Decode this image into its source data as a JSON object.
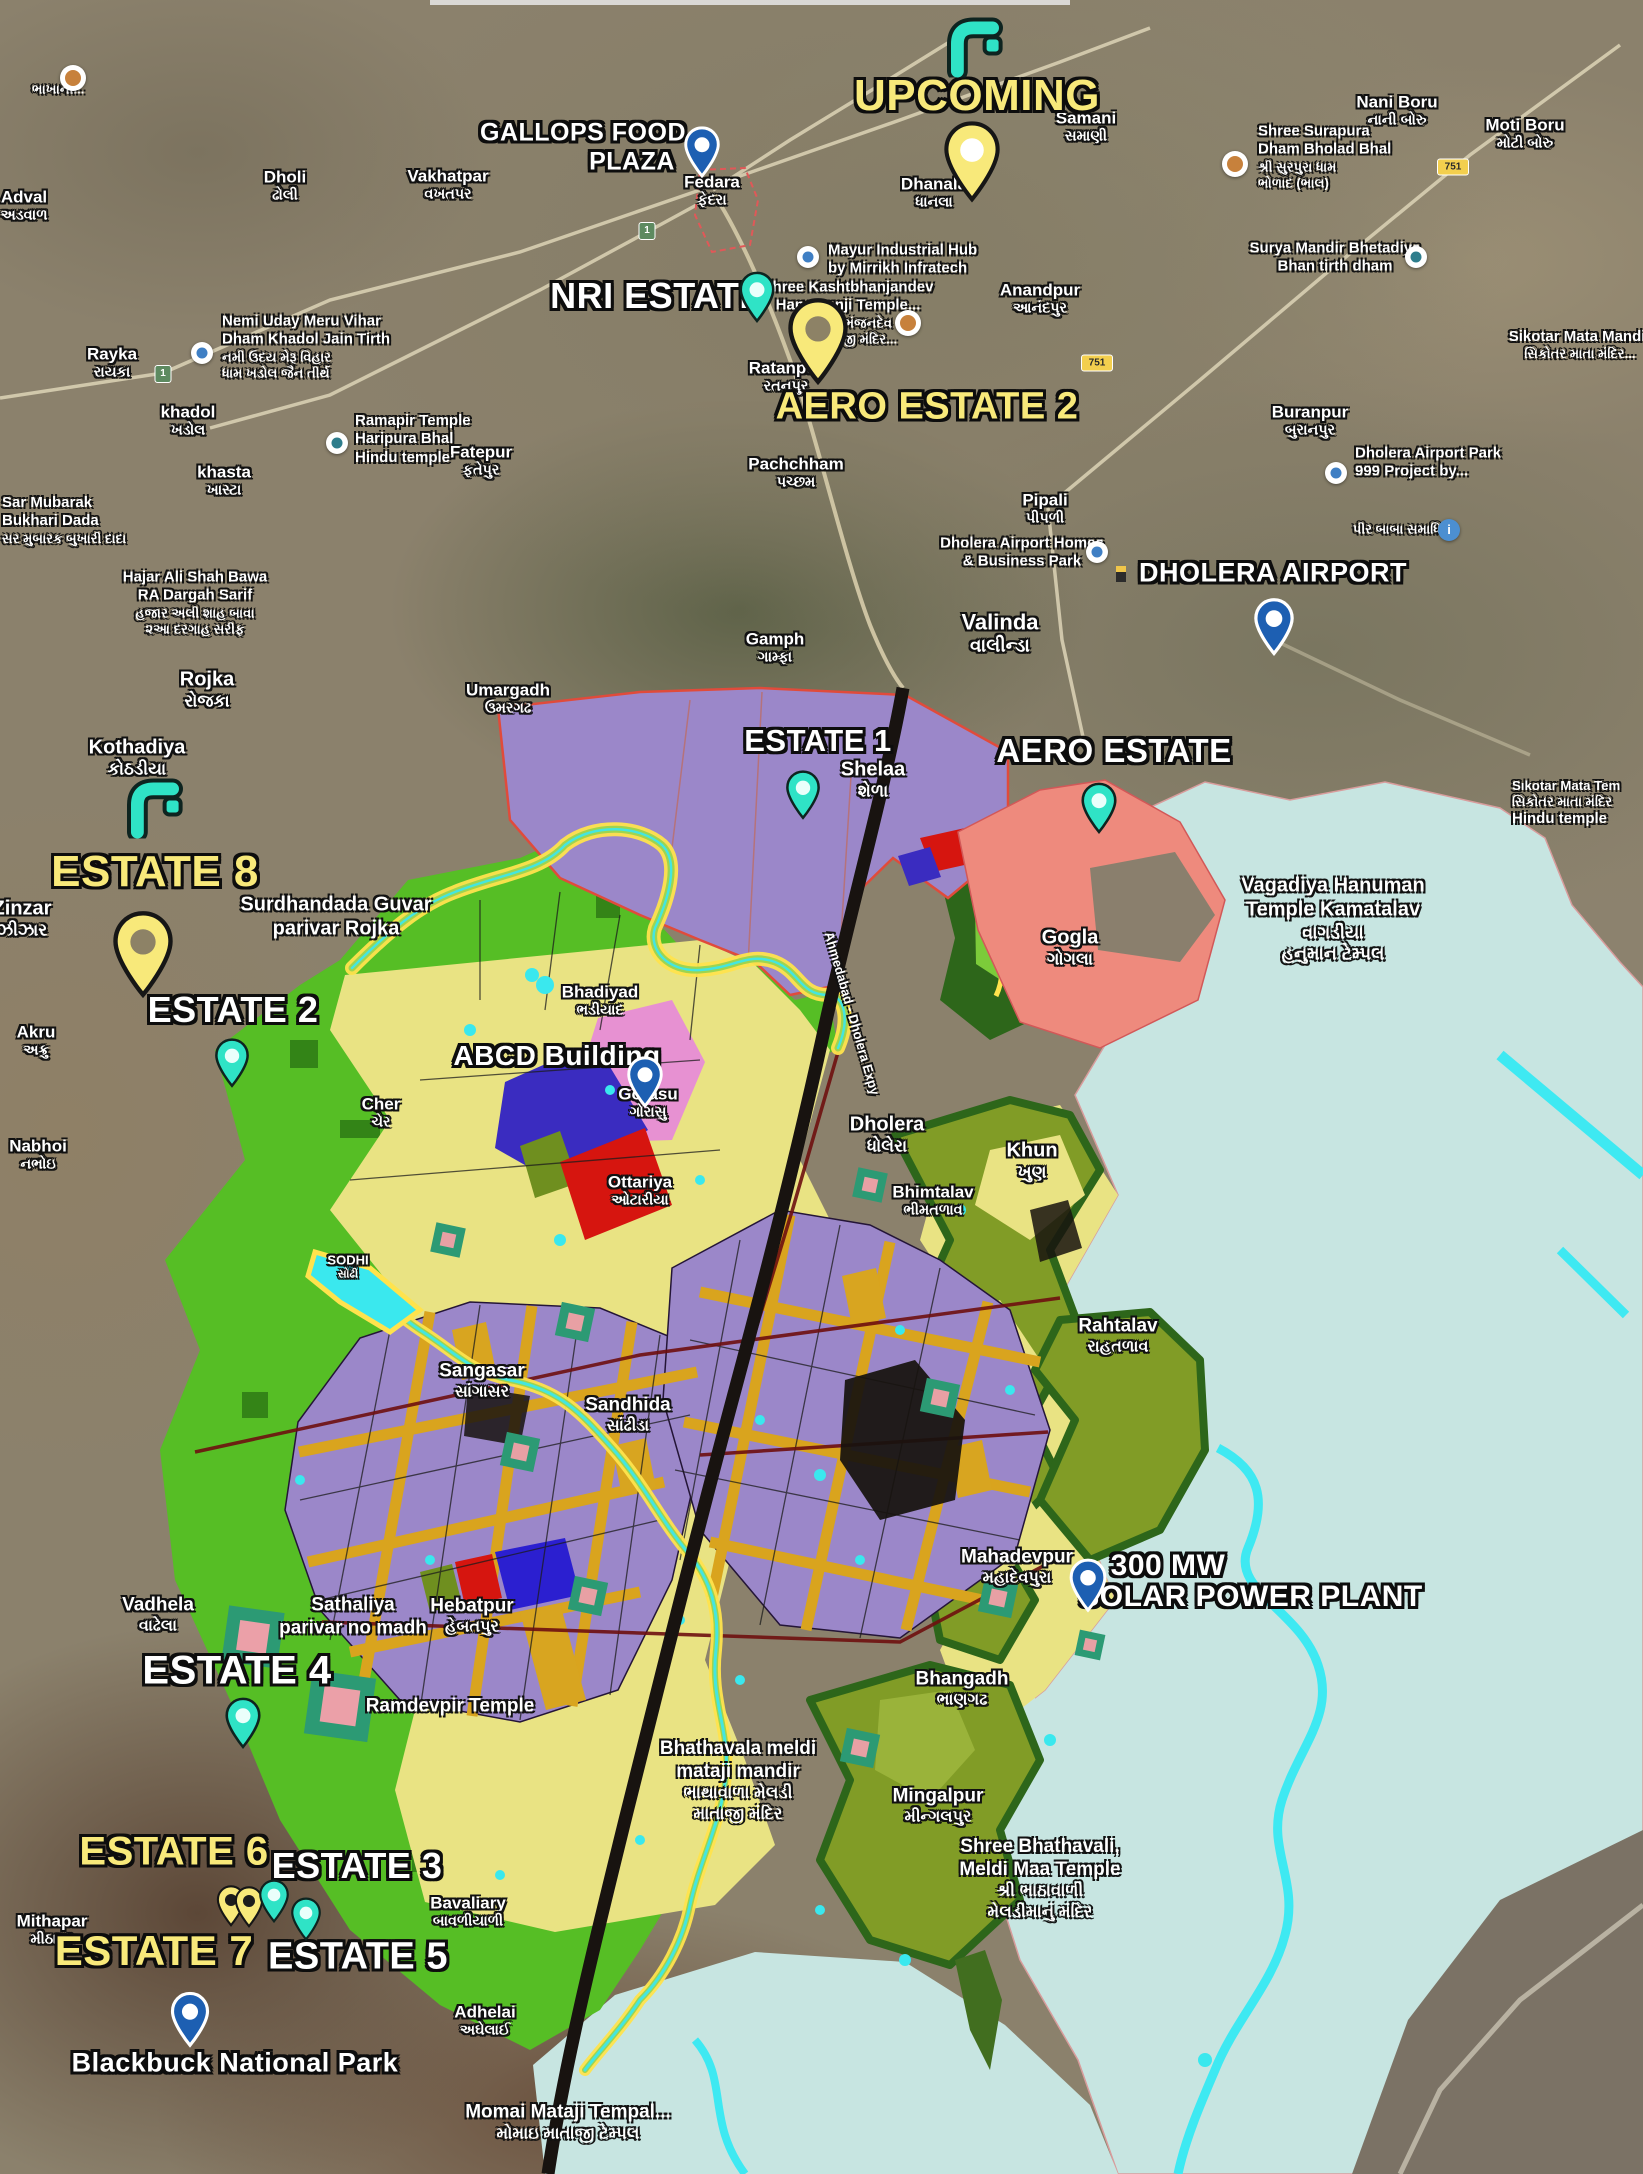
{
  "colors": {
    "teal_pin": "#2fe3c6",
    "yellow_pin": "#f8e97a",
    "blue_pin": "#1d5fb2",
    "yellow_label": "#f8e97a",
    "white_label": "#ffffff",
    "zone_green": "#56be25",
    "zone_khaki": "#e9e383",
    "zone_purple": "#9b87c9",
    "zone_olive": "#819c26",
    "zone_water": "#c7e5e1",
    "zone_salmon": "#ee8a7d",
    "stream_cyan": "#3ee9f2"
  },
  "map": {
    "expressway_label": "Ahmedabad - Dholera Expy",
    "estate_labels": [
      {
        "text": "UPCOMING",
        "color": "yellow",
        "x": 977,
        "y": 96,
        "size": 44
      },
      {
        "text": "GALLOPS FOOD",
        "color": "white",
        "x": 583,
        "y": 133,
        "size": 25
      },
      {
        "text": "PLAZA",
        "color": "white",
        "x": 632,
        "y": 162,
        "size": 25
      },
      {
        "text": "NRI ESTATE",
        "color": "white",
        "x": 657,
        "y": 296,
        "size": 36
      },
      {
        "text": "AERO ESTATE 2",
        "color": "yellow",
        "x": 927,
        "y": 407,
        "size": 38
      },
      {
        "text": "DHOLERA AIRPORT",
        "color": "white",
        "x": 1273,
        "y": 573,
        "size": 27
      },
      {
        "text": "ESTATE 1",
        "color": "white",
        "x": 818,
        "y": 741,
        "size": 31
      },
      {
        "text": "AERO ESTATE",
        "color": "white",
        "x": 1114,
        "y": 751,
        "size": 33
      },
      {
        "text": "ESTATE 8",
        "color": "yellow",
        "x": 155,
        "y": 872,
        "size": 44
      },
      {
        "text": "ESTATE 2",
        "color": "white",
        "x": 233,
        "y": 1010,
        "size": 36
      },
      {
        "text": "ABCD Building",
        "color": "white",
        "x": 557,
        "y": 1056,
        "size": 28
      },
      {
        "text": "300 MW",
        "color": "white",
        "x": 1168,
        "y": 1566,
        "size": 30
      },
      {
        "text": "SOLAR POWER PLANT",
        "color": "white",
        "x": 1251,
        "y": 1597,
        "size": 30
      },
      {
        "text": "ESTATE 4",
        "color": "white",
        "x": 237,
        "y": 1671,
        "size": 40
      },
      {
        "text": "ESTATE 6",
        "color": "yellow",
        "x": 174,
        "y": 1852,
        "size": 40
      },
      {
        "text": "ESTATE 3",
        "color": "white",
        "x": 357,
        "y": 1866,
        "size": 36
      },
      {
        "text": "ESTATE 7",
        "color": "yellow",
        "x": 154,
        "y": 1951,
        "size": 42
      },
      {
        "text": "ESTATE 5",
        "color": "white",
        "x": 358,
        "y": 1957,
        "size": 38
      },
      {
        "text": "Blackbuck National Park",
        "color": "white",
        "x": 235,
        "y": 2063,
        "size": 27
      }
    ],
    "place_labels": [
      {
        "en": "Dholi",
        "gu": "ઢોલી",
        "x": 285,
        "y": 185
      },
      {
        "en": "Vakhatpar",
        "gu": "વખતપર",
        "x": 448,
        "y": 184
      },
      {
        "en": "Adval",
        "gu": "અડવાળ",
        "x": 24,
        "y": 205
      },
      {
        "en": "Dhanala",
        "gu": "ધાનલા",
        "x": 934,
        "y": 192
      },
      {
        "en": "Samani",
        "gu": "સમાણી",
        "x": 1086,
        "y": 126
      },
      {
        "en": "Nani Boru",
        "gu": "નાની બોરુ",
        "x": 1397,
        "y": 110
      },
      {
        "en": "Moti Boru",
        "gu": "મોટી બોરુ",
        "x": 1525,
        "y": 133
      },
      {
        "en": "Fedara",
        "gu": "ફેદરા",
        "x": 712,
        "y": 190
      },
      {
        "en": "Rayka",
        "gu": "રાયકા",
        "x": 112,
        "y": 362
      },
      {
        "en": "khadol",
        "gu": "ખડોલ",
        "x": 188,
        "y": 420
      },
      {
        "en": "khasta",
        "gu": "ખાસ્ટા",
        "x": 224,
        "y": 480
      },
      {
        "en": "Fatepur",
        "gu": "ફતેપુર",
        "x": 481,
        "y": 460
      },
      {
        "en": "Pachchham",
        "gu": "પચ્છમ",
        "x": 796,
        "y": 472
      },
      {
        "en": "Ratanpur",
        "gu": "રતનપુર",
        "x": 786,
        "y": 376
      },
      {
        "en": "Anandpur",
        "gu": "આનંદપુર",
        "x": 1040,
        "y": 298
      },
      {
        "en": "Buranpur",
        "gu": "બુરાનપુર",
        "x": 1310,
        "y": 420
      },
      {
        "en": "Pipali",
        "gu": "પીપળી",
        "x": 1045,
        "y": 508
      },
      {
        "en": "Valinda",
        "gu": "વાલીન્ડા",
        "x": 1000,
        "y": 632,
        "size": 22
      },
      {
        "en": "Gamph",
        "gu": "ગામ્ફા",
        "x": 775,
        "y": 647
      },
      {
        "en": "Umargadh",
        "gu": "ઉમરગઢ",
        "x": 508,
        "y": 698
      },
      {
        "en": "Rojka",
        "gu": "રોજકા",
        "x": 207,
        "y": 689,
        "size": 20
      },
      {
        "en": "Kothadiya",
        "gu": "કોઠડીયા",
        "x": 137,
        "y": 757,
        "size": 20
      },
      {
        "en": "Zinzar",
        "gu": "ઝીઝાર",
        "x": 22,
        "y": 918,
        "size": 20
      },
      {
        "en": "Akru",
        "gu": "અક્રુ",
        "x": 36,
        "y": 1040
      },
      {
        "en": "Nabhoi",
        "gu": "નભોઇ",
        "x": 38,
        "y": 1154
      },
      {
        "en": "Shelaa",
        "gu": "શેળા",
        "x": 873,
        "y": 779,
        "size": 20
      },
      {
        "en": "Gogla",
        "gu": "ગોગલા",
        "x": 1070,
        "y": 947,
        "size": 20
      },
      {
        "en": "Bhadiyad",
        "gu": "ભડીયાદ",
        "x": 600,
        "y": 1000
      },
      {
        "en": "Cher",
        "gu": "ચેર",
        "x": 381,
        "y": 1112
      },
      {
        "en": "Gorasu",
        "gu": "ગોરાસુ",
        "x": 648,
        "y": 1102
      },
      {
        "en": "Ottariya",
        "gu": "ઓટારીયા",
        "x": 640,
        "y": 1190
      },
      {
        "en": "Dholera",
        "gu": "ધોલેરા",
        "x": 887,
        "y": 1134,
        "size": 20
      },
      {
        "en": "Khun",
        "gu": "ખુણ",
        "x": 1032,
        "y": 1160,
        "size": 20
      },
      {
        "en": "Bhimtalav",
        "gu": "ભીમતળાવ",
        "x": 933,
        "y": 1200
      },
      {
        "en": "SODHI",
        "gu": "સોઢી",
        "x": 348,
        "y": 1267,
        "size": 13
      },
      {
        "en": "Sangasar",
        "gu": "સાંગાસર",
        "x": 482,
        "y": 1380,
        "size": 19
      },
      {
        "en": "Sandhida",
        "gu": "સાંઢીડા",
        "x": 628,
        "y": 1414,
        "size": 19
      },
      {
        "en": "Rahtalav",
        "gu": "રાહતળાવ",
        "x": 1118,
        "y": 1335,
        "size": 19
      },
      {
        "en": "Mahadevpur",
        "gu": "મહાદેવપુરા",
        "x": 1017,
        "y": 1566,
        "size": 19
      },
      {
        "en": "Vadhela",
        "gu": "વાઢેલા",
        "x": 158,
        "y": 1614,
        "size": 19
      },
      {
        "en": "Hebatpur",
        "gu": "હેબતપુર",
        "x": 472,
        "y": 1615,
        "size": 19
      },
      {
        "en": "Bhangadh",
        "gu": "ભાણગઢ",
        "x": 962,
        "y": 1688,
        "size": 19
      },
      {
        "en": "Mingalpur",
        "gu": "મીન્ગલપુર",
        "x": 938,
        "y": 1805,
        "size": 19
      },
      {
        "en": "Mithapar",
        "gu": "મીઠાપર",
        "x": 52,
        "y": 1929
      },
      {
        "en": "Bavaliary",
        "gu": "બાવળીયાળી",
        "x": 468,
        "y": 1911
      },
      {
        "en": "Adhelai",
        "gu": "અઘેલાઈ",
        "x": 485,
        "y": 2020
      }
    ],
    "poi_labels": [
      {
        "lines": [
          "ભાખાની..."
        ],
        "x": 32,
        "y": 88,
        "align": "left"
      },
      {
        "lines": [
          "Shree Surapura",
          "Dham Bholad Bhal",
          "શ્રી સુરપુરા ધામ",
          "ભોળાદ (ભાલ)"
        ],
        "x": 1258,
        "y": 150,
        "align": "left"
      },
      {
        "lines": [
          "Surya Mandir Bhetadiya",
          "Bhan tirth dham"
        ],
        "x": 1335,
        "y": 254
      },
      {
        "lines": [
          "Sikotar Mata Mandir",
          "સિકોતર માતા મંદિર..."
        ],
        "x": 1580,
        "y": 342
      },
      {
        "lines": [
          "Nemi Uday Meru Vihar",
          "Dham Khadol Jain Tirth",
          "નમી ઉદય મેરૂ વિહાર",
          "ધામ ખડોલ જૈન તીર્થ"
        ],
        "x": 222,
        "y": 340,
        "align": "left"
      },
      {
        "lines": [
          "Ramapir Temple",
          "Haripura Bhal",
          "Hindu temple"
        ],
        "x": 355,
        "y": 434,
        "align": "left"
      },
      {
        "lines": [
          "Sar Mubarak",
          "Bukhari Dada",
          "સર મુબારક બુખારી દાદા"
        ],
        "x": 2,
        "y": 515,
        "align": "left"
      },
      {
        "lines": [
          "Hajar Ali Shah Bawa",
          "RA Dargah Sarif",
          "હજાર અલી શાહ બાવા",
          "૨આ દરગાહ સરીફ"
        ],
        "x": 195,
        "y": 596
      },
      {
        "lines": [
          "Mayur Industrial Hub",
          "by Mirrikh Infratech"
        ],
        "x": 828,
        "y": 256,
        "align": "left"
      },
      {
        "lines": [
          "Shree Kashtbhanjandev",
          "Hanumanji Temple...",
          "શ્રી કષ્ટભંજનદેવ",
          "હનુમાનજી મંદિર..."
        ],
        "x": 848,
        "y": 306
      },
      {
        "lines": [
          "Dholera Airport Park",
          "999 Project by..."
        ],
        "x": 1355,
        "y": 459,
        "align": "left"
      },
      {
        "lines": [
          "પીર બાબા સમાધિ"
        ],
        "x": 1397,
        "y": 528
      },
      {
        "lines": [
          "Dholera Airport Homes",
          "& Business Park"
        ],
        "x": 1022,
        "y": 549
      },
      {
        "lines": [
          "Sıkotar Mata Tem",
          "સિકોતર માતા મંદિર",
          "Hindu temple"
        ],
        "x": 1512,
        "y": 798,
        "align": "left"
      },
      {
        "lines": [
          "Vagadiya Hanuman",
          "Temple Kamatalav",
          "વાગડીયા",
          "હનુમાન ટેમ્પલ"
        ],
        "x": 1333,
        "y": 910,
        "size": 20
      },
      {
        "lines": [
          "Surdhandada Guvar",
          "parivar Rojka"
        ],
        "x": 336,
        "y": 912,
        "size": 20
      },
      {
        "lines": [
          "Sathaliya",
          "parivar no madh"
        ],
        "x": 353,
        "y": 1612,
        "size": 19
      },
      {
        "lines": [
          "Ramdevpir Temple"
        ],
        "x": 450,
        "y": 1704,
        "size": 19
      },
      {
        "lines": [
          "Bhathavala meldi",
          "mataji mandir",
          "ભાથાવાળા મેલડી",
          "માતાજી મંદિર"
        ],
        "x": 738,
        "y": 1772,
        "size": 19
      },
      {
        "lines": [
          "Shree Bhathavali,",
          "Meldi Maa Temple",
          "શ્રી ભાઠાવાળી",
          "મેલડીમાનું મંદિર"
        ],
        "x": 1040,
        "y": 1870,
        "size": 19
      },
      {
        "lines": [
          "Momai Mataji Tempal...",
          "મોમાઇ માતાજી ટેમ્પલ"
        ],
        "x": 568,
        "y": 2118,
        "size": 19
      }
    ],
    "pins": [
      {
        "name": "gallops-food-plaza",
        "kind": "blue",
        "x": 702,
        "y": 146,
        "h": 52
      },
      {
        "name": "upcoming",
        "kind": "yellowBig",
        "x": 972,
        "y": 152,
        "h": 82,
        "hole": "#ffffff"
      },
      {
        "name": "nri-estate",
        "kind": "teal",
        "x": 757,
        "y": 291,
        "h": 52
      },
      {
        "name": "aero-estate-2",
        "kind": "yellowBig",
        "x": 818,
        "y": 331,
        "h": 88,
        "hole": "#8d8266"
      },
      {
        "name": "dholera-airport",
        "kind": "blue",
        "x": 1274,
        "y": 620,
        "h": 58
      },
      {
        "name": "estate-1",
        "kind": "teal",
        "x": 803,
        "y": 789,
        "h": 50
      },
      {
        "name": "aero-estate",
        "kind": "teal",
        "x": 1099,
        "y": 802,
        "h": 52
      },
      {
        "name": "estate-8",
        "kind": "yellowBig",
        "x": 143,
        "y": 944,
        "h": 88,
        "hole": "#8d8266"
      },
      {
        "name": "estate-2",
        "kind": "teal",
        "x": 232,
        "y": 1057,
        "h": 50
      },
      {
        "name": "abcd-building",
        "kind": "blue",
        "x": 645,
        "y": 1076,
        "h": 52
      },
      {
        "name": "solar-power-plant",
        "kind": "blue",
        "x": 1088,
        "y": 1579,
        "h": 54
      },
      {
        "name": "estate-4",
        "kind": "teal",
        "x": 243,
        "y": 1717,
        "h": 52
      },
      {
        "name": "estate-6-a",
        "kind": "yellow",
        "x": 231,
        "y": 1901,
        "h": 42
      },
      {
        "name": "estate-6-b",
        "kind": "yellow",
        "x": 249,
        "y": 1902,
        "h": 42
      },
      {
        "name": "estate-3",
        "kind": "teal",
        "x": 274,
        "y": 1896,
        "h": 44
      },
      {
        "name": "estate-5",
        "kind": "teal",
        "x": 306,
        "y": 1914,
        "h": 44
      },
      {
        "name": "estate-7",
        "kind": "blue",
        "x": 190,
        "y": 2013,
        "h": 56
      }
    ],
    "arrow_icons": [
      {
        "name": "upcoming-arrow",
        "x": 975,
        "y": 48,
        "s": 64
      },
      {
        "name": "estate-8-arrow",
        "x": 155,
        "y": 809,
        "s": 64
      }
    ],
    "poi_icons": [
      {
        "type": "photo",
        "x": 73,
        "y": 78
      },
      {
        "type": "dot",
        "x": 202,
        "y": 353
      },
      {
        "type": "om",
        "x": 337,
        "y": 443
      },
      {
        "type": "photo",
        "x": 1235,
        "y": 164
      },
      {
        "type": "om",
        "x": 1416,
        "y": 257
      },
      {
        "type": "dot",
        "x": 808,
        "y": 257
      },
      {
        "type": "photo",
        "x": 908,
        "y": 323
      },
      {
        "type": "dot",
        "x": 1336,
        "y": 473
      },
      {
        "type": "info",
        "x": 1449,
        "y": 530
      },
      {
        "type": "dot",
        "x": 1097,
        "y": 552
      }
    ],
    "road_shields": [
      {
        "text": "1",
        "kind": "green",
        "x": 647,
        "y": 231
      },
      {
        "text": "1",
        "kind": "green",
        "x": 163,
        "y": 374
      },
      {
        "text": "751",
        "kind": "yellow",
        "x": 1453,
        "y": 167
      },
      {
        "text": "751",
        "kind": "yellow",
        "x": 1097,
        "y": 363
      }
    ]
  }
}
